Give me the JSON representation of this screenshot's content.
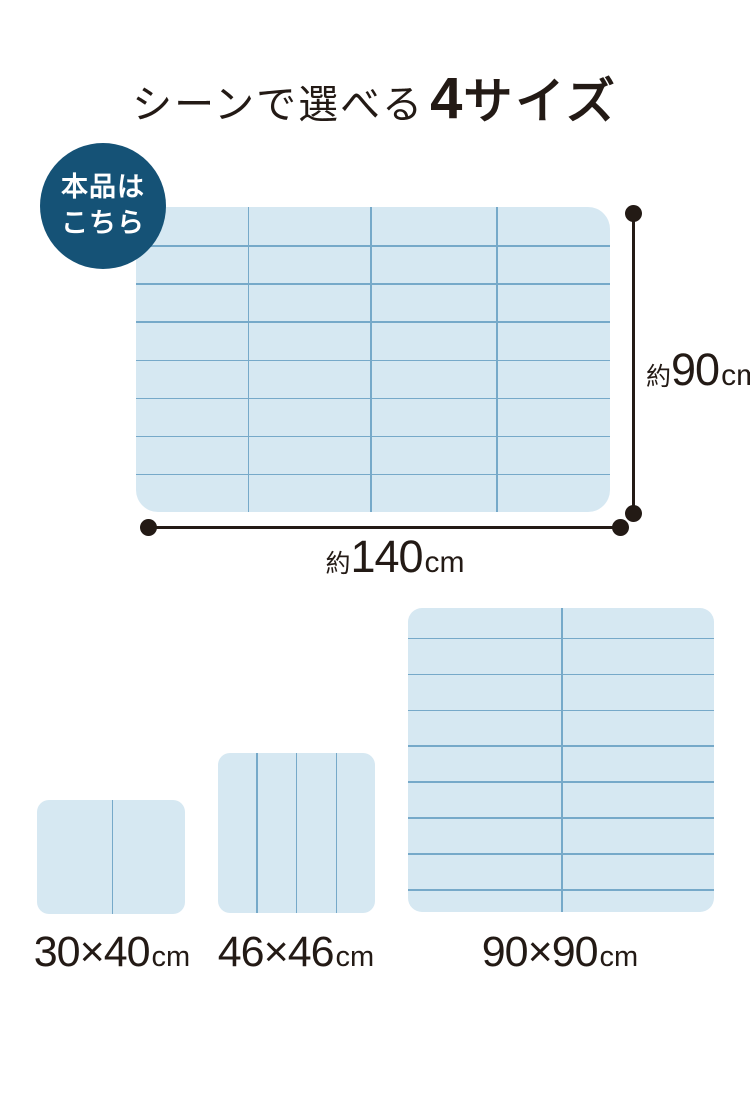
{
  "title": {
    "regular": "シーンで選べる",
    "big_number": "4",
    "emphasis": "サイズ"
  },
  "badge": {
    "line1": "本品は",
    "line2": "こちら"
  },
  "main_mat": {
    "height_label": {
      "prefix": "約",
      "value": "90",
      "unit": "cm"
    },
    "width_label": {
      "prefix": "約",
      "value": "140",
      "unit": "cm"
    }
  },
  "size_options": [
    {
      "value": "30×40",
      "unit": "cm"
    },
    {
      "value": "46×46",
      "unit": "cm"
    },
    {
      "value": "90×90",
      "unit": "cm"
    }
  ],
  "mats": {
    "main": {
      "vlines": [
        23.6,
        49.4,
        76.0
      ],
      "hlines": [
        12.5,
        25,
        37.5,
        50,
        62.5,
        75,
        87.5
      ]
    },
    "size90": {
      "vlines": [
        50
      ],
      "hlines": [
        9.8,
        21.6,
        33.4,
        45.2,
        57.0,
        68.9,
        80.7,
        92.5
      ]
    },
    "size46": {
      "vlines": [
        24.5,
        49.5,
        75.0
      ],
      "hlines": []
    },
    "size30": {
      "vlines": [
        50.5
      ],
      "hlines": []
    }
  },
  "colors": {
    "badge_bg": "#155276",
    "badge_text": "#ffffff",
    "mat_fill": "#D6E8F2",
    "mat_line": "#76A9C9",
    "ink": "#231A15",
    "page_bg": "#ffffff"
  }
}
